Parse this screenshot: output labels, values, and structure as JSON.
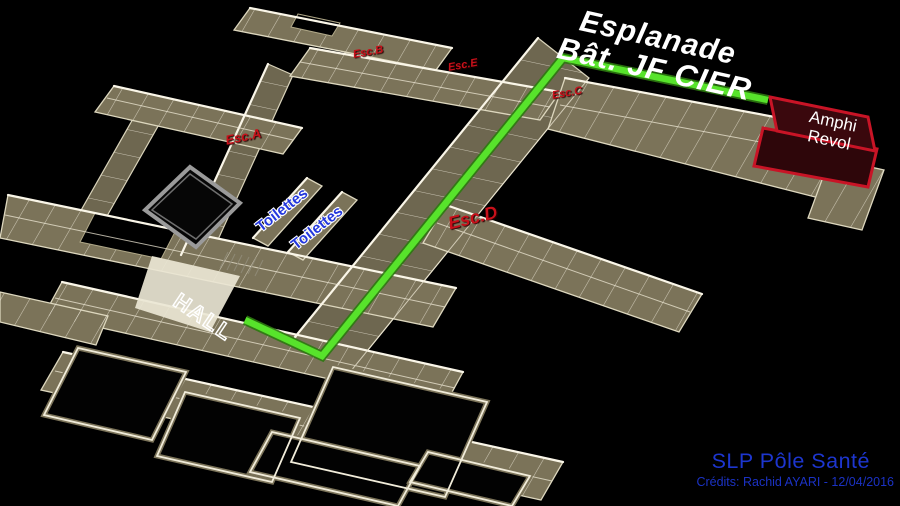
{
  "map": {
    "title": {
      "line1": "Esplanade",
      "line2": "Bât. JF CIER"
    },
    "amphi": {
      "line1": "Amphi",
      "line2": "Revol"
    },
    "stairs": {
      "a": "Esc.A",
      "b": "Esc.B",
      "c": "Esc.C",
      "d": "Esc.D",
      "e": "Esc.E"
    },
    "rooms": {
      "toilettes": "Toilettes",
      "hall": "HALL"
    },
    "route": {
      "color": "#57e32b"
    },
    "footer": {
      "site": "SLP Pôle Santé",
      "credits": "Crédits: Rachid AYARI - 12/04/2016"
    },
    "colors": {
      "background": "#000000",
      "walls": "#7b7359",
      "wall_edges": "#efe9d6",
      "route_green": "#57e32b",
      "stair_red": "#c8101a",
      "toilettes_blue": "#2438dd",
      "footer_blue": "#1d36cf",
      "amphi_red": "#c81426",
      "courtyard_gray": "#9a9a9a"
    }
  }
}
